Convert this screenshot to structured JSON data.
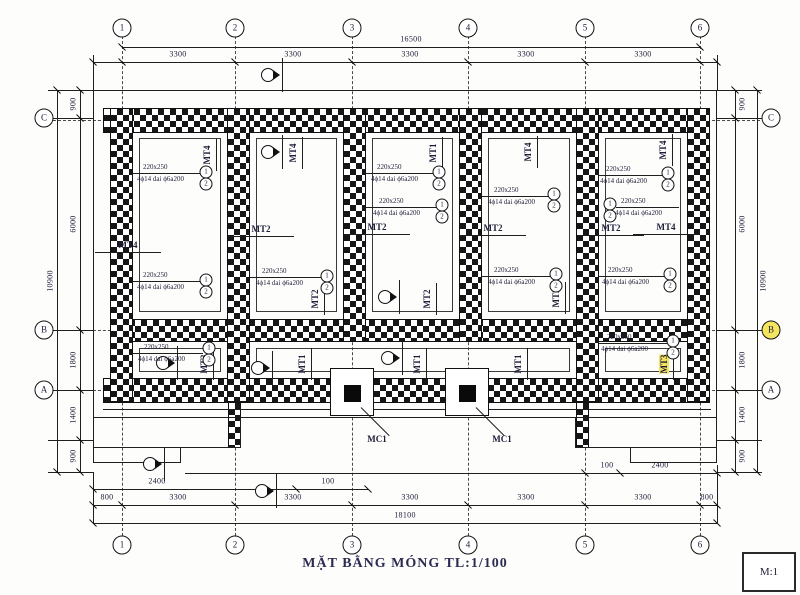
{
  "title": "MẶT BẰNG MÓNG TL:1/100",
  "scale_box": "M:1",
  "axes": {
    "top": [
      {
        "n": "1",
        "x": 122
      },
      {
        "n": "2",
        "x": 235
      },
      {
        "n": "3",
        "x": 352
      },
      {
        "n": "4",
        "x": 468
      },
      {
        "n": "5",
        "x": 585
      },
      {
        "n": "6",
        "x": 700
      }
    ],
    "bottom": [
      {
        "n": "1",
        "x": 122
      },
      {
        "n": "2",
        "x": 235
      },
      {
        "n": "3",
        "x": 352
      },
      {
        "n": "4",
        "x": 468
      },
      {
        "n": "5",
        "x": 585
      },
      {
        "n": "6",
        "x": 700
      }
    ],
    "left": [
      {
        "n": "C",
        "y": 118
      },
      {
        "n": "B",
        "y": 330
      },
      {
        "n": "A",
        "y": 390
      }
    ],
    "right": [
      {
        "n": "C",
        "y": 118
      },
      {
        "n": "B",
        "y": 330,
        "hl": true
      },
      {
        "n": "A",
        "y": 390
      }
    ]
  },
  "dims": {
    "top_overall": {
      "text": "16500",
      "x": 411,
      "y": 39
    },
    "top_segments": [
      {
        "text": "3300",
        "x": 178,
        "y": 54
      },
      {
        "text": "3300",
        "x": 293,
        "y": 54
      },
      {
        "text": "3300",
        "x": 410,
        "y": 54
      },
      {
        "text": "3300",
        "x": 526,
        "y": 54
      },
      {
        "text": "3300",
        "x": 643,
        "y": 54
      }
    ],
    "bottom_sub": [
      {
        "text": "2400",
        "x": 157,
        "y": 481
      },
      {
        "text": "100",
        "x": 328,
        "y": 481
      },
      {
        "text": "100",
        "x": 607,
        "y": 465
      },
      {
        "text": "2400",
        "x": 660,
        "y": 465
      }
    ],
    "bottom_main": [
      {
        "text": "800",
        "x": 107,
        "y": 497
      },
      {
        "text": "3300",
        "x": 178,
        "y": 497
      },
      {
        "text": "3300",
        "x": 293,
        "y": 497
      },
      {
        "text": "3300",
        "x": 410,
        "y": 497
      },
      {
        "text": "3300",
        "x": 526,
        "y": 497
      },
      {
        "text": "3300",
        "x": 643,
        "y": 497
      },
      {
        "text": "800",
        "x": 707,
        "y": 497
      }
    ],
    "bottom_overall": {
      "text": "18100",
      "x": 405,
      "y": 515
    },
    "left_segments": [
      {
        "text": "900",
        "x": 73,
        "y": 104
      },
      {
        "text": "6000",
        "x": 73,
        "y": 224
      },
      {
        "text": "1800",
        "x": 73,
        "y": 360
      },
      {
        "text": "1400",
        "x": 73,
        "y": 415
      },
      {
        "text": "900",
        "x": 73,
        "y": 456
      }
    ],
    "left_overall": {
      "text": "10900",
      "x": 50,
      "y": 281
    },
    "right_segments": [
      {
        "text": "900",
        "x": 742,
        "y": 104
      },
      {
        "text": "6000",
        "x": 742,
        "y": 224
      },
      {
        "text": "1800",
        "x": 742,
        "y": 360
      },
      {
        "text": "1400",
        "x": 742,
        "y": 415
      },
      {
        "text": "900",
        "x": 742,
        "y": 456
      }
    ],
    "right_overall": {
      "text": "10900",
      "x": 763,
      "y": 281
    }
  },
  "beams": {
    "horizontal": [
      {
        "text": "MT4",
        "x": 128,
        "y": 245
      },
      {
        "text": "MT2",
        "x": 261,
        "y": 229
      },
      {
        "text": "MT2",
        "x": 377,
        "y": 227
      },
      {
        "text": "MT2",
        "x": 493,
        "y": 228
      },
      {
        "text": "MT2",
        "x": 611,
        "y": 228
      },
      {
        "text": "MT4",
        "x": 666,
        "y": 227
      }
    ],
    "vertical": [
      {
        "text": "MT4",
        "x": 207,
        "y": 155
      },
      {
        "text": "MT4",
        "x": 293,
        "y": 153
      },
      {
        "text": "MT1",
        "x": 433,
        "y": 153
      },
      {
        "text": "MT4",
        "x": 528,
        "y": 152
      },
      {
        "text": "MT4",
        "x": 663,
        "y": 150
      },
      {
        "text": "MT2",
        "x": 315,
        "y": 299
      },
      {
        "text": "MT2",
        "x": 427,
        "y": 299
      },
      {
        "text": "MT2",
        "x": 556,
        "y": 298
      },
      {
        "text": "MT3",
        "x": 204,
        "y": 364
      },
      {
        "text": "MT1",
        "x": 302,
        "y": 364
      },
      {
        "text": "MT1",
        "x": 417,
        "y": 364
      },
      {
        "text": "MT1",
        "x": 518,
        "y": 364
      },
      {
        "text": "MT3",
        "x": 664,
        "y": 364,
        "hl": true
      }
    ]
  },
  "rebar_groups": [
    {
      "size": "220x250",
      "bars": "4ϕ14 dai ϕ6a200",
      "x": 143,
      "y": 163,
      "cx": 206,
      "cy": 172,
      "side": "r",
      "lx": 133,
      "marks": [
        "1",
        "2"
      ]
    },
    {
      "size": "220x250",
      "bars": "4ϕ14 dai ϕ6a200",
      "x": 143,
      "y": 271,
      "cx": 206,
      "cy": 280,
      "side": "r",
      "lx": 133,
      "marks": [
        "1",
        "2"
      ]
    },
    {
      "size": "220x250",
      "bars": "4ϕ14 dai ϕ6a200",
      "x": 144,
      "y": 343,
      "cx": 209,
      "cy": 348,
      "side": "r",
      "lx": 133,
      "marks": [
        "1",
        "2"
      ]
    },
    {
      "size": "220x250",
      "bars": "4ϕ14 dai ϕ6a200",
      "x": 262,
      "y": 267,
      "cx": 327,
      "cy": 276,
      "side": "r",
      "lx": 250,
      "marks": [
        "1",
        "2"
      ]
    },
    {
      "size": "220x250",
      "bars": "4ϕ14 dai ϕ6a200",
      "x": 377,
      "y": 163,
      "cx": 439,
      "cy": 172,
      "side": "r",
      "lx": 366,
      "marks": [
        "1",
        "2"
      ]
    },
    {
      "size": "220x250",
      "bars": "4ϕ14 dai ϕ6a200",
      "x": 379,
      "y": 197,
      "cx": 442,
      "cy": 205,
      "side": "r",
      "lx": 366,
      "marks": [
        "1",
        "2"
      ]
    },
    {
      "size": "220x250",
      "bars": "4ϕ14 dai ϕ6a200",
      "x": 494,
      "y": 186,
      "cx": 554,
      "cy": 194,
      "side": "r",
      "lx": 482,
      "marks": [
        "1",
        "2"
      ]
    },
    {
      "size": "220x250",
      "bars": "4ϕ14 dai ϕ6a200",
      "x": 494,
      "y": 266,
      "cx": 556,
      "cy": 274,
      "side": "r",
      "lx": 482,
      "marks": [
        "1",
        "2"
      ]
    },
    {
      "size": "220x250",
      "bars": "4ϕ14 dai ϕ6a200",
      "x": 606,
      "y": 165,
      "cx": 668,
      "cy": 173,
      "side": "r",
      "lx": 599,
      "marks": [
        "1",
        "2"
      ]
    },
    {
      "size": "220x250",
      "bars": "4ϕ14 dai ϕ6a200",
      "x": 621,
      "y": 197,
      "cx": 610,
      "cy": 204,
      "side": "l",
      "lx": 616,
      "marks": [
        "1",
        "2"
      ]
    },
    {
      "size": "220x250",
      "bars": "4ϕ14 dai ϕ6a200",
      "x": 608,
      "y": 266,
      "cx": 670,
      "cy": 274,
      "side": "r",
      "lx": 599,
      "marks": [
        "1",
        "2"
      ]
    },
    {
      "size": "220x250",
      "bars": "4ϕ14 dai ϕ6a200",
      "x": 607,
      "y": 333,
      "cx": 673,
      "cy": 341,
      "side": "r",
      "lx": 599,
      "marks": [
        "1",
        "2"
      ]
    }
  ],
  "columns": [
    {
      "label": "MC1",
      "x": 377,
      "y": 439
    },
    {
      "label": "MC1",
      "x": 502,
      "y": 439
    }
  ]
}
